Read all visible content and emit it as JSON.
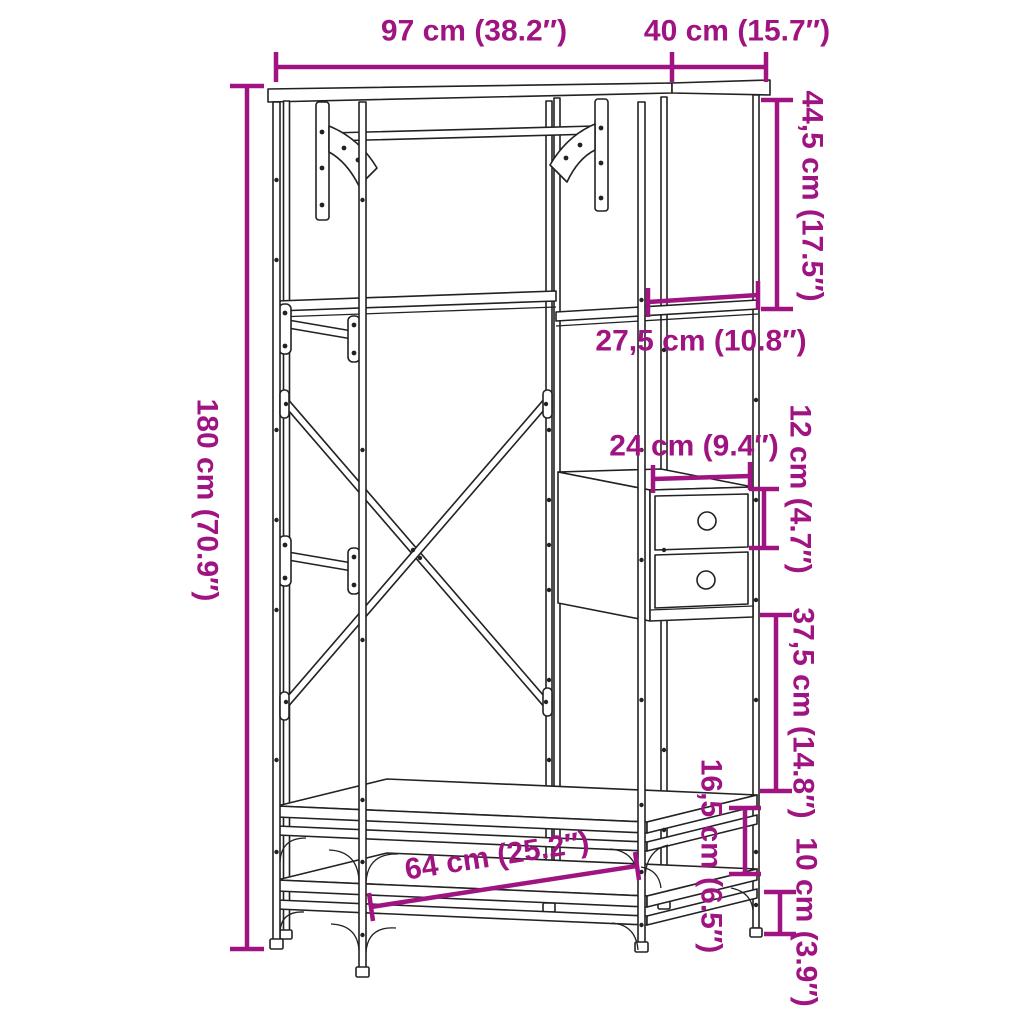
{
  "diagram": {
    "type": "furniture-dimension-diagram",
    "product": "clothes-rack-with-shelves-and-drawers",
    "accent_color": "#A01482",
    "line_color": "#222222",
    "background_color": "#FFFFFF",
    "dimensions": {
      "overall_width": {
        "label": "97 cm (38.2″)",
        "cm": 97,
        "inches": 38.2,
        "orientation": "horizontal"
      },
      "overall_depth": {
        "label": "40 cm (15.7″)",
        "cm": 40,
        "inches": 15.7,
        "orientation": "horizontal"
      },
      "overall_height": {
        "label": "180 cm (70.9″)",
        "cm": 180,
        "inches": 70.9,
        "orientation": "vertical"
      },
      "upper_right_compartment_height": {
        "label": "44,5 cm (17.5″)",
        "cm": 44.5,
        "inches": 17.5,
        "orientation": "vertical"
      },
      "right_shelf_depth": {
        "label": "27,5 cm (10.8″)",
        "cm": 27.5,
        "inches": 10.8,
        "orientation": "horizontal"
      },
      "drawer_width": {
        "label": "24 cm (9.4″)",
        "cm": 24,
        "inches": 9.4,
        "orientation": "horizontal"
      },
      "drawer_height": {
        "label": "12 cm (4.7″)",
        "cm": 12,
        "inches": 4.7,
        "orientation": "vertical"
      },
      "lower_right_compartment_height": {
        "label": "37,5 cm (14.8″)",
        "cm": 37.5,
        "inches": 14.8,
        "orientation": "vertical"
      },
      "bench_shelf_gap": {
        "label": "16,5 cm (6.5″)",
        "cm": 16.5,
        "inches": 6.5,
        "orientation": "vertical"
      },
      "bottom_clearance": {
        "label": "10 cm (3.9″)",
        "cm": 10,
        "inches": 3.9,
        "orientation": "vertical"
      },
      "bottom_shelf_width": {
        "label": "64 cm (25.2″)",
        "cm": 64,
        "inches": 25.2,
        "orientation": "slanted"
      }
    }
  }
}
